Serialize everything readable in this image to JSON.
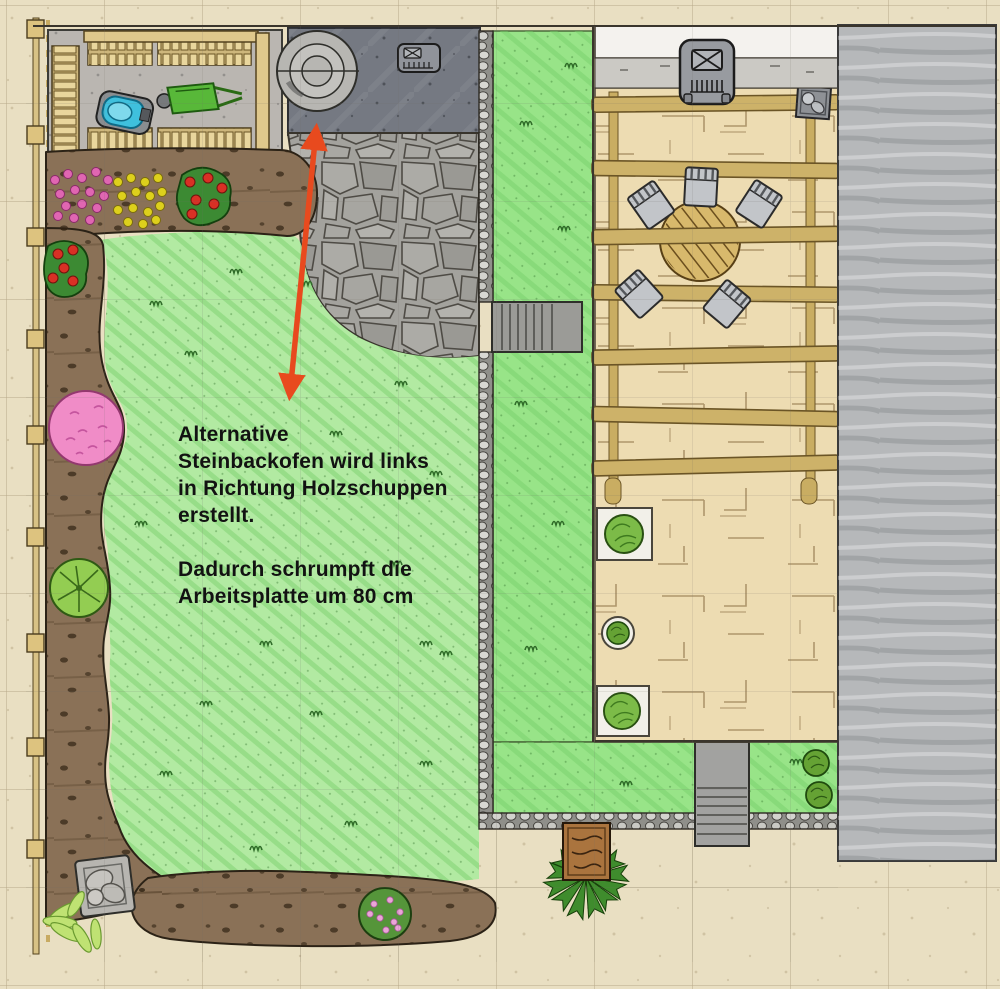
{
  "annotation": {
    "lines": [
      "Alternative",
      "Steinbackofen wird links",
      "in Richtung Holzschuppen",
      "erstellt.",
      "",
      "Dadurch schrumpft die",
      "Arbeitsplatte um 80 cm"
    ],
    "text_color": "#121212"
  },
  "colors": {
    "background": "#e9dfc2",
    "lawn": "#b2eaa2",
    "lawn_strip": "#98e488",
    "soil": "#8a7157",
    "terrace": "#eddcb2",
    "building": "#b6b8ba",
    "flagstone": "#a3a29d",
    "concrete_dark": "#757982",
    "concrete_light": "#bab6b1",
    "pergola_beam": "#cdb269",
    "arrow": "#e84a1e"
  },
  "icons": {
    "grill": "grill-icon",
    "drain_cover": "drain-cover-icon",
    "stone_oven_rings": "stone-oven-icon"
  }
}
